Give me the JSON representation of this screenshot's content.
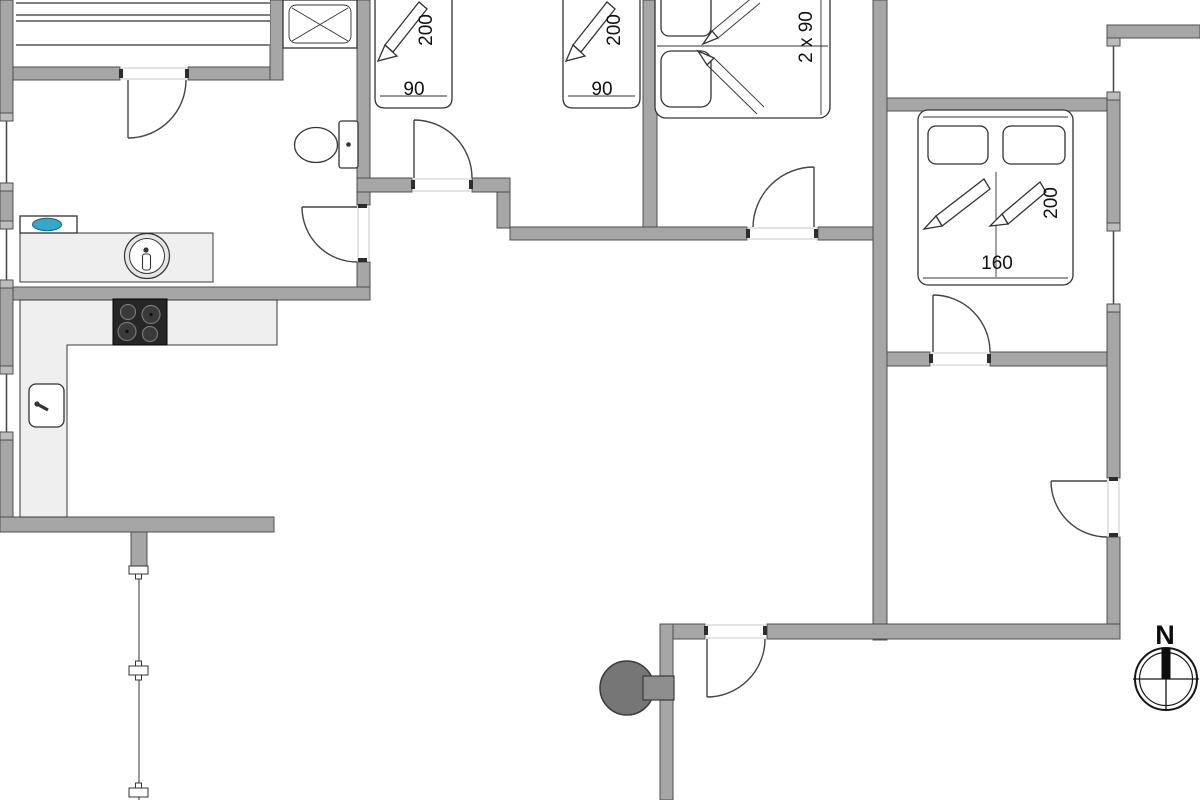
{
  "labels": {
    "bed_room1_length": "200",
    "bed_room1_width": "90",
    "bed_room2_length": "200",
    "bed_room2_width": "90",
    "bed_room3_size": "2 x 90",
    "bed_room4_length": "200",
    "bed_room4_width": "160",
    "compass_north": "N"
  },
  "colors": {
    "wall": "#a6a6a6",
    "wall-outline": "#4f4f4f",
    "counter": "#efefef",
    "hob": "#262626",
    "water": "#35a7c9",
    "lamp": "#767676",
    "line": "#333333"
  },
  "fixtures": [
    "wardrobe",
    "shower",
    "toilet",
    "washbasin",
    "utility-sink",
    "kitchen-counter",
    "hob",
    "kitchen-sink",
    "single-bed",
    "single-bed",
    "double-bed-2x90",
    "double-bed-160",
    "outdoor-lamp",
    "fence",
    "compass-rose"
  ]
}
